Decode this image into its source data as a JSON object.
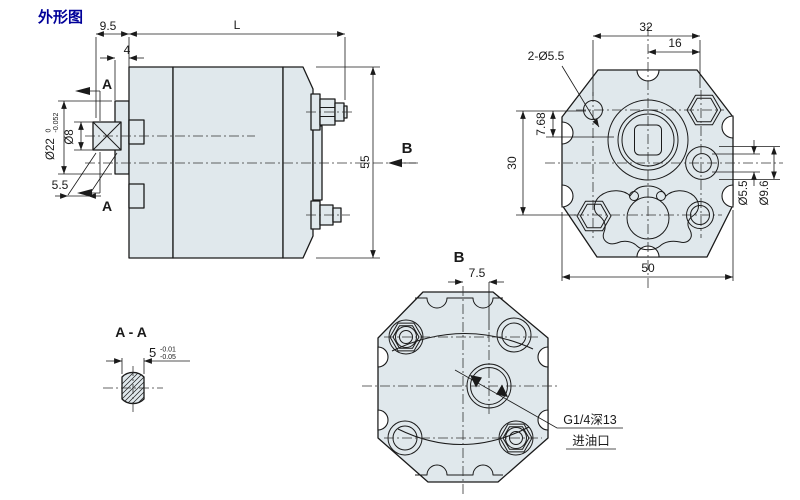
{
  "title": "外形图",
  "colors": {
    "body_fill": "#e0e8ec",
    "line": "#1a1a1a",
    "centerline": "#333333",
    "title": "#000099"
  },
  "side_view": {
    "dim_9_5": "9.5",
    "dim_4": "4",
    "dim_length": "L",
    "dim_height": "55",
    "dim_flat": "5.5",
    "section_label_top": "A",
    "section_label_bottom": "A",
    "view_label": "B",
    "pilot_dia": "Ø22",
    "pilot_tol_upper": "0",
    "pilot_tol_lower": "-0.052",
    "shaft_dia": "Ø8"
  },
  "front_view": {
    "dim_32": "32",
    "dim_16": "16",
    "mount_holes_label": "2-Ø5.5",
    "dim_7_68": "7.68",
    "dim_30": "30",
    "hole_dia": "Ø5.5",
    "cbore_dia": "Ø9.6",
    "dim_50": "50"
  },
  "b_view": {
    "view_label": "B",
    "dim_7_5": "7.5",
    "port_thread": "G1/4深13",
    "port_name": "进油口"
  },
  "section_aa": {
    "label": "A - A",
    "dim_5": "5",
    "tol_upper": "-0.01",
    "tol_lower": "-0.05"
  }
}
